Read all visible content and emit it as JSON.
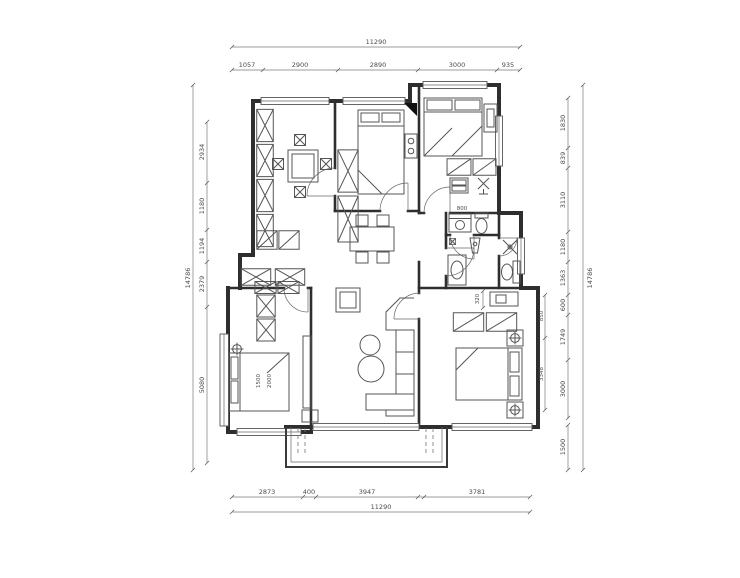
{
  "meta": {
    "drawing_type": "residential apartment floor plan",
    "units": "mm",
    "ink_color": "#2e2e2e",
    "background": "#ffffff"
  },
  "dims": {
    "top": {
      "total": "11290",
      "segments": [
        "1057",
        "2900",
        "2890",
        "3000",
        "935"
      ]
    },
    "bottom": {
      "total": "11290",
      "segments": [
        "2873",
        "400",
        "3947",
        "3781"
      ]
    },
    "left": {
      "total": "14786",
      "segments": [
        "2934",
        "1180",
        "1194",
        "2379",
        "5080"
      ]
    },
    "right": {
      "total": "14786",
      "segments": [
        "1830",
        "839",
        "3110",
        "1180",
        "1363",
        "600",
        "1749",
        "3000"
      ],
      "balcony": "1500"
    },
    "master_bedroom": {
      "bed_side": "850",
      "bed_length": "3348",
      "desk_depth": "320"
    },
    "bathroom": {
      "laundry_width": "800"
    },
    "small_bedroom": {
      "bed_width": "1500",
      "bed_length": "2000"
    }
  }
}
